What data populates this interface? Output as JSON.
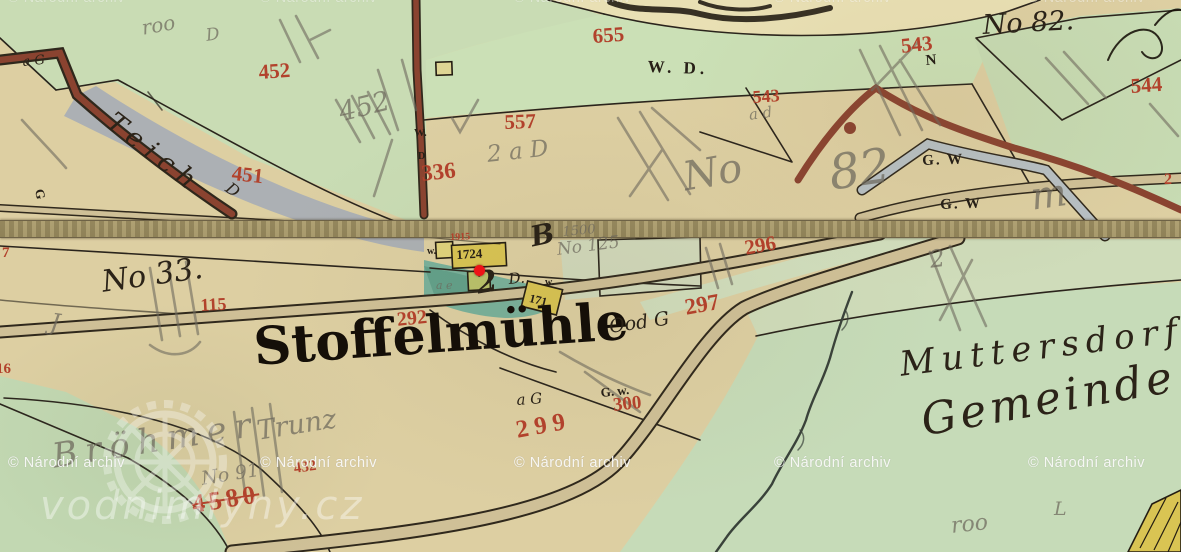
{
  "app": {
    "description": "Historical cadastral map view (water-mill map portal)",
    "palette": {
      "paper_tan": "#ddcfa2",
      "field_green": "#c9dcb4",
      "pond_grey": "#a7aeb5",
      "millpond_teal": "#79b19b",
      "road_tan": "#cfc097",
      "road_brown": "#8a4330",
      "parcel_red": "#b2422c",
      "ink_black": "#272017",
      "pencil_grey": "#6d685c",
      "marker_red": "#ee1317",
      "watermark_white": "#ffffff"
    }
  },
  "marker": {
    "color": "#ee1317",
    "shape": "dot"
  },
  "watermarks": {
    "archive_text": "© Národní archiv",
    "logo_text": "vodnimlyny.cz",
    "rows": [
      {
        "y": -10,
        "cls": "wm-faint",
        "positions": [
          8,
          260,
          514,
          774,
          1028
        ]
      },
      {
        "y": 455,
        "cls": "",
        "positions": [
          8,
          260,
          514,
          774,
          1028
        ]
      }
    ]
  },
  "map": {
    "main_place_name": "Stoffelmühle",
    "labels": [
      {
        "t": "452",
        "x": 258,
        "y": 62,
        "s": 21,
        "r": -4,
        "cl": "red"
      },
      {
        "t": "451",
        "x": 233,
        "y": 163,
        "s": 21,
        "r": 6,
        "cl": "red"
      },
      {
        "t": "655",
        "x": 592,
        "y": 26,
        "s": 21,
        "r": -4,
        "cl": "red"
      },
      {
        "t": "557",
        "x": 504,
        "y": 112,
        "s": 21,
        "r": -2,
        "cl": "red"
      },
      {
        "t": "336",
        "x": 420,
        "y": 162,
        "s": 23,
        "r": -6,
        "cl": "red"
      },
      {
        "t": "543",
        "x": 900,
        "y": 36,
        "s": 21,
        "r": -6,
        "cl": "red"
      },
      {
        "t": "543",
        "x": 752,
        "y": 88,
        "s": 18,
        "r": -4,
        "cl": "red"
      },
      {
        "t": "544",
        "x": 1130,
        "y": 76,
        "s": 21,
        "r": -4,
        "cl": "red"
      },
      {
        "t": "296",
        "x": 743,
        "y": 238,
        "s": 21,
        "r": -10,
        "cl": "red"
      },
      {
        "t": "297",
        "x": 683,
        "y": 296,
        "s": 23,
        "r": -10,
        "cl": "red"
      },
      {
        "t": "292",
        "x": 396,
        "y": 310,
        "s": 20,
        "r": -6,
        "cl": "red"
      },
      {
        "t": "299",
        "x": 514,
        "y": 418,
        "s": 25,
        "r": -10,
        "cl": "red",
        "ls": 6
      },
      {
        "t": "300",
        "x": 612,
        "y": 396,
        "s": 19,
        "r": -6,
        "cl": "red"
      },
      {
        "t": "115",
        "x": 200,
        "y": 296,
        "s": 18,
        "r": -3,
        "cl": "red"
      },
      {
        "t": "1915",
        "x": 450,
        "y": 233,
        "s": 10,
        "r": -2,
        "cl": "red"
      },
      {
        "t": "4580",
        "x": 190,
        "y": 492,
        "s": 26,
        "r": -9,
        "cl": "red",
        "ls": 4,
        "st": 1
      },
      {
        "t": "432",
        "x": 293,
        "y": 462,
        "s": 15,
        "r": -8,
        "cl": "red"
      },
      {
        "t": "2",
        "x": 1164,
        "y": 172,
        "s": 16,
        "r": 0,
        "cl": "red"
      },
      {
        "t": "16",
        "x": -4,
        "y": 362,
        "s": 15,
        "r": 0,
        "cl": "red"
      },
      {
        "t": "7",
        "x": 2,
        "y": 246,
        "s": 15,
        "r": 0,
        "cl": "red"
      },
      {
        "t": "No 33.",
        "x": 100,
        "y": 268,
        "s": 30,
        "r": -8,
        "cl": "script"
      },
      {
        "t": "Stoffelmühle",
        "x": 252,
        "y": 322,
        "s": 52,
        "r": -4,
        "cl": "fraktur"
      },
      {
        "t": "W. D.",
        "x": 648,
        "y": 58,
        "s": 17,
        "r": 2,
        "cl": "ink",
        "ls": 4
      },
      {
        "t": "G. W",
        "x": 922,
        "y": 154,
        "s": 15,
        "r": -2,
        "cl": "ink",
        "ls": 2
      },
      {
        "t": "G. W",
        "x": 940,
        "y": 198,
        "s": 15,
        "r": -2,
        "cl": "ink",
        "ls": 2
      },
      {
        "t": "No 82.",
        "x": 982,
        "y": 12,
        "s": 27,
        "r": -3,
        "cl": "script"
      },
      {
        "t": "Ood G",
        "x": 608,
        "y": 318,
        "s": 19,
        "r": -8,
        "cl": "script"
      },
      {
        "t": "G. w.",
        "x": 600,
        "y": 386,
        "s": 13,
        "r": -6,
        "cl": "ink"
      },
      {
        "t": "a G",
        "x": 516,
        "y": 393,
        "s": 15,
        "r": -4,
        "cl": "script"
      },
      {
        "t": "a G",
        "x": 22,
        "y": 56,
        "s": 13,
        "r": -6,
        "cl": "script"
      },
      {
        "t": "W.",
        "x": 414,
        "y": 128,
        "s": 11,
        "r": 0,
        "cl": "ink"
      },
      {
        "t": "D",
        "x": 418,
        "y": 152,
        "s": 10,
        "r": 0,
        "cl": "ink"
      },
      {
        "t": "w.",
        "x": 427,
        "y": 247,
        "s": 10,
        "r": 0,
        "cl": "ink"
      },
      {
        "t": "w.",
        "x": 545,
        "y": 278,
        "s": 10,
        "r": 0,
        "cl": "ink"
      },
      {
        "t": "D.",
        "x": 508,
        "y": 272,
        "s": 15,
        "r": -5,
        "cl": "script"
      },
      {
        "t": "2",
        "x": 474,
        "y": 270,
        "s": 30,
        "r": -10,
        "cl": "script",
        "b": 1
      },
      {
        "t": "1724",
        "x": 456,
        "y": 248,
        "s": 13,
        "r": -3,
        "cl": "ink"
      },
      {
        "t": "171",
        "x": 531,
        "y": 292,
        "s": 12,
        "r": 14,
        "cl": "ink"
      },
      {
        "t": "N",
        "x": 925,
        "y": 54,
        "s": 15,
        "r": -5,
        "cl": "ink"
      },
      {
        "t": "Teich",
        "x": 118,
        "y": 108,
        "s": 27,
        "r": 38,
        "cl": "script",
        "ls": 8
      },
      {
        "t": "D",
        "x": 232,
        "y": 180,
        "s": 16,
        "r": 36,
        "cl": "script"
      },
      {
        "t": "Muttersdorf",
        "x": 898,
        "y": 348,
        "s": 34,
        "r": -7,
        "cl": "script",
        "ls": 7
      },
      {
        "t": "Gemeinde",
        "x": 918,
        "y": 400,
        "s": 44,
        "r": -10,
        "cl": "script",
        "ls": 4
      },
      {
        "t": "G",
        "x": 46,
        "y": 188,
        "s": 13,
        "r": 80,
        "cl": "ink"
      },
      {
        "t": "B",
        "x": 528,
        "y": 224,
        "s": 28,
        "r": -12,
        "cl": "script",
        "b": 1
      },
      {
        "t": "roo",
        "x": 140,
        "y": 18,
        "s": 20,
        "r": -10,
        "cl": "pencil"
      },
      {
        "t": "D",
        "x": 205,
        "y": 28,
        "s": 17,
        "r": -8,
        "cl": "pencil"
      },
      {
        "t": "452",
        "x": 336,
        "y": 100,
        "s": 27,
        "r": -14,
        "cl": "pencil"
      },
      {
        "t": "2 a D",
        "x": 486,
        "y": 144,
        "s": 23,
        "r": -6,
        "cl": "pencil"
      },
      {
        "t": "No",
        "x": 680,
        "y": 158,
        "s": 40,
        "r": -10,
        "cl": "pencil"
      },
      {
        "t": "82",
        "x": 826,
        "y": 150,
        "s": 48,
        "r": -8,
        "cl": "pencil"
      },
      {
        "t": "m",
        "x": 1028,
        "y": 178,
        "s": 38,
        "r": -8,
        "cl": "pencil"
      },
      {
        "t": "No 125",
        "x": 556,
        "y": 242,
        "s": 17,
        "r": -7,
        "cl": "pencil"
      },
      {
        "t": "1500",
        "x": 562,
        "y": 226,
        "s": 13,
        "r": -5,
        "cl": "pencil"
      },
      {
        "t": "a d",
        "x": 748,
        "y": 108,
        "s": 15,
        "r": -8,
        "cl": "pencil"
      },
      {
        "t": "No 91",
        "x": 200,
        "y": 470,
        "s": 19,
        "r": -9,
        "cl": "pencil"
      },
      {
        "t": "Bröhmer",
        "x": 50,
        "y": 440,
        "s": 34,
        "r": -9,
        "cl": "pencil",
        "ls": 8
      },
      {
        "t": "Trunz",
        "x": 255,
        "y": 418,
        "s": 27,
        "r": -9,
        "cl": "pencil"
      },
      {
        "t": "roo",
        "x": 950,
        "y": 516,
        "s": 22,
        "r": -6,
        "cl": "pencil"
      },
      {
        "t": "L",
        "x": 1054,
        "y": 500,
        "s": 19,
        "r": 0,
        "cl": "pencil"
      },
      {
        "t": "J",
        "x": 52,
        "y": 310,
        "s": 24,
        "r": 8,
        "cl": "pencil"
      },
      {
        "t": "a e",
        "x": 436,
        "y": 280,
        "s": 11,
        "r": 0,
        "cl": "pencil"
      },
      {
        "t": "2",
        "x": 928,
        "y": 248,
        "s": 24,
        "r": -8,
        "cl": "pencil"
      }
    ]
  }
}
